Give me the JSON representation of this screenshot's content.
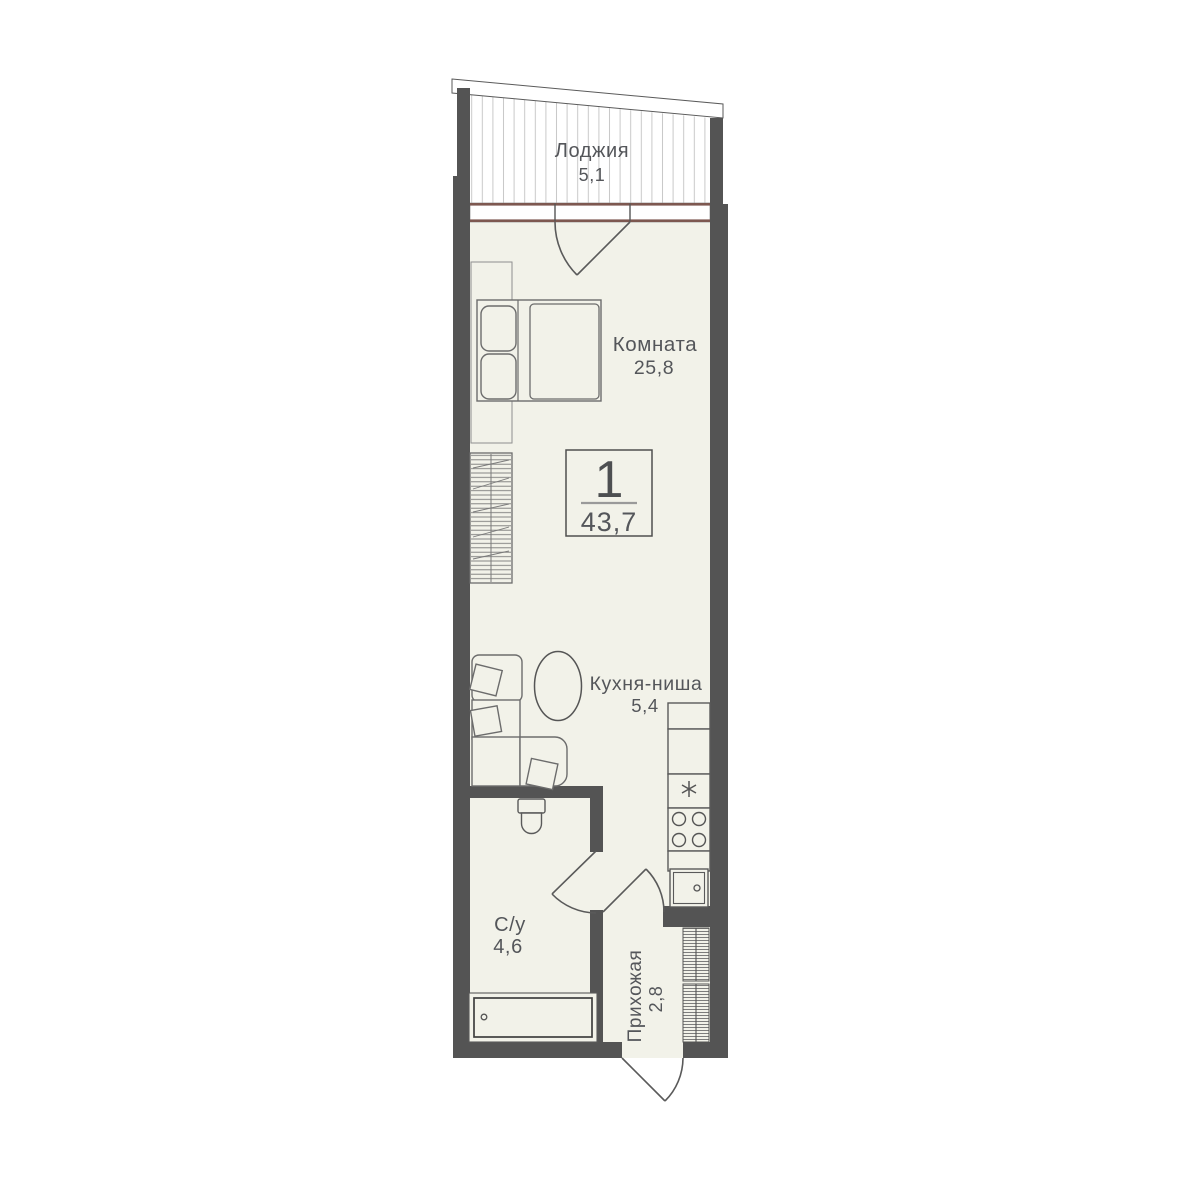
{
  "plan": {
    "badge": {
      "rooms_count": "1",
      "total_area": "43,7"
    },
    "rooms": {
      "loggia": {
        "name": "Лоджия",
        "area": "5,1"
      },
      "living": {
        "name": "Комната",
        "area": "25,8"
      },
      "kitchen": {
        "name": "Кухня-ниша",
        "area": "5,4"
      },
      "bathroom": {
        "name": "С/у",
        "area": "4,6"
      },
      "hallway": {
        "name": "Прихожая",
        "area": "2,8"
      }
    },
    "colors": {
      "wall": "#545454",
      "floor": "#f2f2e9",
      "window_frame": "#7d5850",
      "furniture_outline": "#6c6c6c",
      "glazing_line": "#c8c8c8",
      "text": "#54565a",
      "background": "#ffffff"
    },
    "icons": {
      "sink": "six-point-asterisk",
      "stove": "four-burner-circles",
      "fridge": "square-with-dot",
      "bathtub_drain": "small-circle",
      "wardrobe": "hanger-hatch"
    }
  }
}
